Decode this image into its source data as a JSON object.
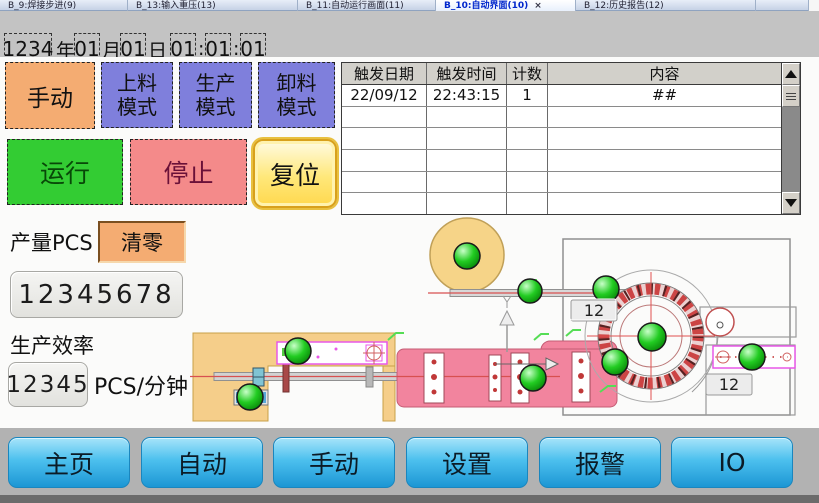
{
  "window": {
    "tabs": [
      {
        "label": "B_9:焊接步进(9)",
        "active": false
      },
      {
        "label": "B_13:输入重压(13)",
        "active": false
      },
      {
        "label": "B_11:自动运行画面(11)",
        "active": false
      },
      {
        "label": "B_10:自动界面(10)",
        "active": true,
        "close": "×"
      },
      {
        "label": "B_12:历史报告(12)",
        "active": false
      }
    ]
  },
  "datetime": {
    "year": "1234",
    "year_unit": "年",
    "month": "01",
    "month_unit": "月",
    "day": "01",
    "day_unit": "日",
    "hour": "01",
    "minute": "01",
    "second": "01",
    "sep": ":"
  },
  "modes": {
    "manual": "手动",
    "load_line1": "上料",
    "load_line2": "模式",
    "prod_line1": "生产",
    "prod_line2": "模式",
    "unload_line1": "卸料",
    "unload_line2": "模式"
  },
  "controls": {
    "run": "运行",
    "stop": "停止",
    "reset": "复位"
  },
  "alarm_table": {
    "headers": [
      "触发日期",
      "触发时间",
      "计数",
      "内容"
    ],
    "row": {
      "date": "22/09/12",
      "time": "22:43:15",
      "count": "1",
      "content": "##"
    }
  },
  "production": {
    "label": "产量PCS",
    "clear": "清零",
    "total": "12345678",
    "eff_label": "生产效率",
    "eff_value": "12345",
    "eff_unit": "PCS/分钟"
  },
  "nav": {
    "items": [
      "主页",
      "自动",
      "手动",
      "设置",
      "报警",
      "IO"
    ]
  },
  "diagram": {
    "counter_top": "12",
    "counter_right": "12"
  },
  "colors": {
    "manual_orange": "#f4ac72",
    "mode_purple": "#7f7fdc",
    "run_green": "#33cc33",
    "stop_red": "#f48a8a",
    "reset_yellow": "#ffe87a",
    "nav_blue": "#1c96d4",
    "lamp_green": "#22cc22",
    "reel_yellow": "#f6d488",
    "body_pink": "#f2849e"
  }
}
